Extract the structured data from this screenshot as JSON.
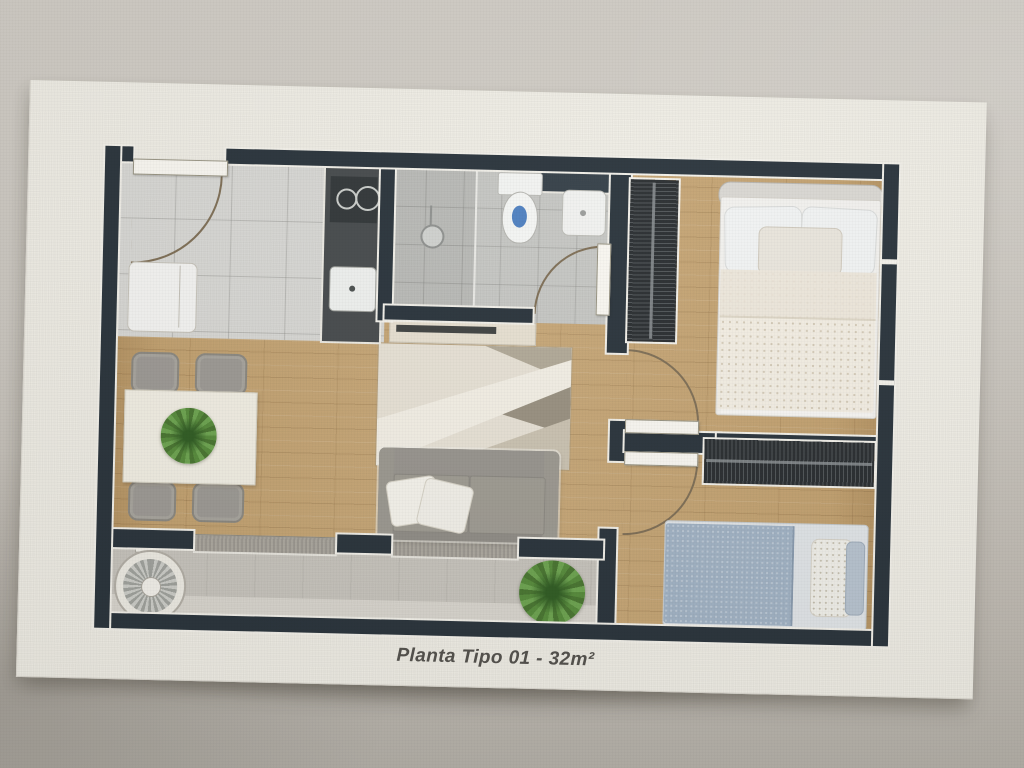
{
  "photo": {
    "caption": "Planta Tipo 01 - 32m²"
  },
  "palette": {
    "wall_background": "#c7c3bc",
    "board": "#f0eee6",
    "plan_walls": "#28323a",
    "wood_floor": "#c2a06e",
    "kitchen_tile": "#d8d8d5",
    "bathroom_tile": "#c6c7c4",
    "balcony_floor": "#c7c4bd",
    "sofa_gray": "#8e8b85",
    "bed2_blanket": "#9fb1c3",
    "toilet_water": "#4d7fc0",
    "plant_green": "#55823d",
    "caption_text": "#514f4b"
  },
  "plan": {
    "type": "floor-plan",
    "rooms": [
      "kitchen-entry",
      "bathroom",
      "living-dining",
      "bedroom-1",
      "bedroom-2",
      "balcony-laundry"
    ],
    "furniture": [
      "entry-door",
      "refrigerator",
      "kitchen-counter",
      "cooktop",
      "kitchen-sink",
      "shower",
      "toilet",
      "washbasin",
      "bathroom-door",
      "tv-console",
      "rug",
      "sofa",
      "dining-table",
      "dining-chairs",
      "table-plant",
      "double-bed",
      "wardrobe-bedroom-1",
      "wardrobe-bedroom-2",
      "single-bed",
      "bedroom-doors",
      "washing-machine",
      "balcony-plant",
      "sliding-window-wall"
    ]
  }
}
